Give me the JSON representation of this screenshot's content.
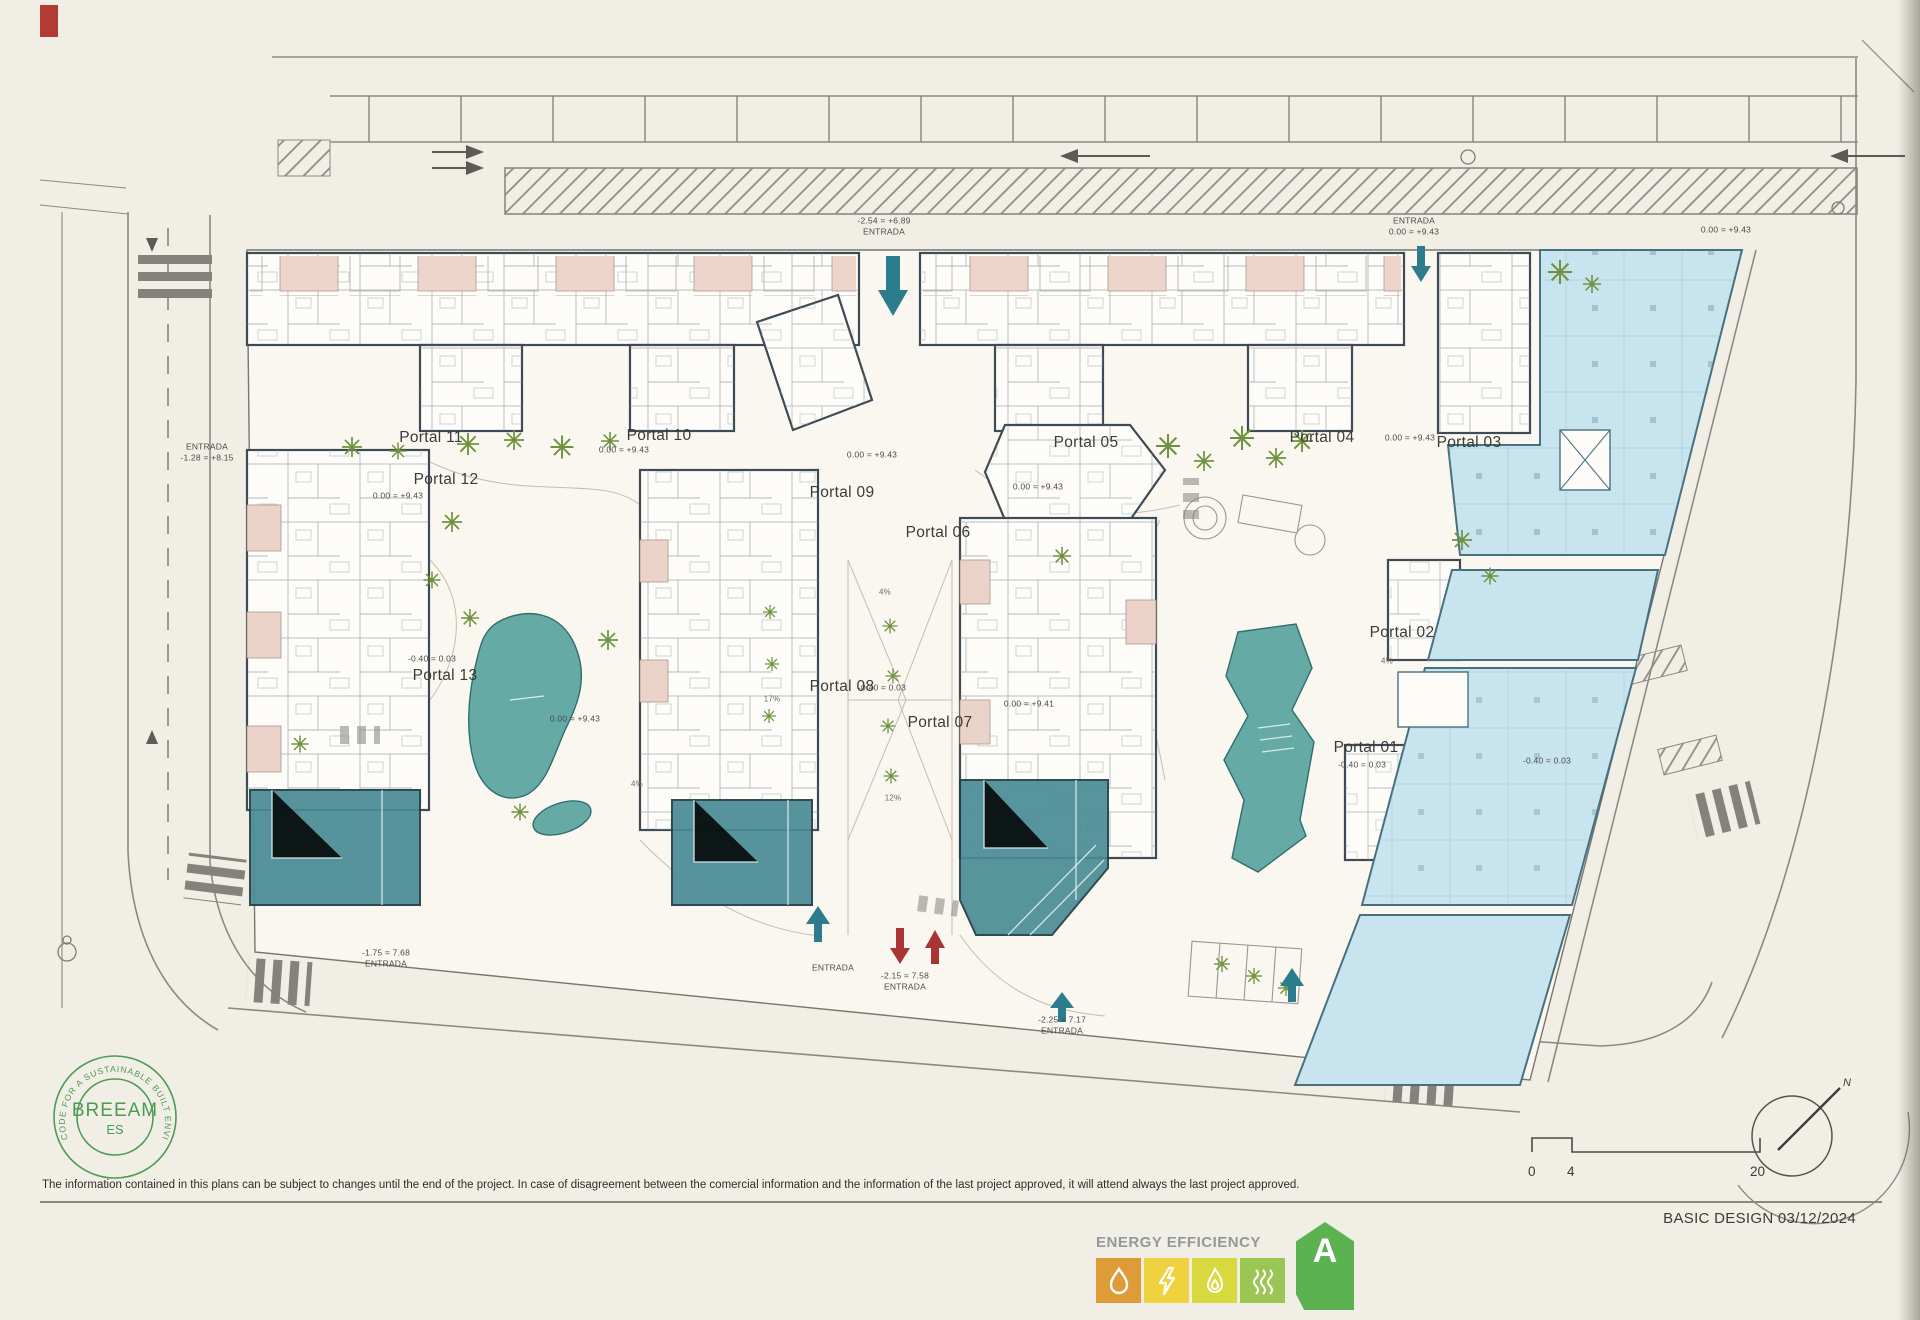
{
  "plan": {
    "portals": [
      {
        "id": "portal-11",
        "label": "Portal 11",
        "x": 431,
        "y": 438
      },
      {
        "id": "portal-10",
        "label": "Portal 10",
        "x": 659,
        "y": 436
      },
      {
        "id": "portal-12",
        "label": "Portal 12",
        "x": 446,
        "y": 480
      },
      {
        "id": "portal-13",
        "label": "Portal 13",
        "x": 445,
        "y": 676
      },
      {
        "id": "portal-09",
        "label": "Portal 09",
        "x": 842,
        "y": 493
      },
      {
        "id": "portal-08",
        "label": "Portal 08",
        "x": 842,
        "y": 687
      },
      {
        "id": "portal-07",
        "label": "Portal 07",
        "x": 940,
        "y": 723
      },
      {
        "id": "portal-06",
        "label": "Portal 06",
        "x": 938,
        "y": 533
      },
      {
        "id": "portal-05",
        "label": "Portal 05",
        "x": 1086,
        "y": 443
      },
      {
        "id": "portal-04",
        "label": "Portal 04",
        "x": 1322,
        "y": 438
      },
      {
        "id": "portal-03",
        "label": "Portal 03",
        "x": 1469,
        "y": 443
      },
      {
        "id": "portal-02",
        "label": "Portal 02",
        "x": 1402,
        "y": 633
      },
      {
        "id": "portal-01",
        "label": "Portal 01",
        "x": 1366,
        "y": 748
      }
    ],
    "annotations": [
      {
        "x": 884,
        "y": 227,
        "lines": [
          "-2.54 = +6.89",
          "ENTRADA"
        ]
      },
      {
        "x": 1414,
        "y": 227,
        "lines": [
          "ENTRADA",
          "0.00 = +9.43"
        ]
      },
      {
        "x": 1726,
        "y": 230,
        "lines": [
          "0.00 = +9.43"
        ]
      },
      {
        "x": 207,
        "y": 453,
        "lines": [
          "ENTRADA",
          "-1.28 = +8.15"
        ]
      },
      {
        "x": 624,
        "y": 450,
        "lines": [
          "0.00 = +9.43"
        ]
      },
      {
        "x": 398,
        "y": 496,
        "lines": [
          "0.00 = +9.43"
        ]
      },
      {
        "x": 872,
        "y": 455,
        "lines": [
          "0.00 = +9.43"
        ]
      },
      {
        "x": 1410,
        "y": 438,
        "lines": [
          "0.00 = +9.43"
        ]
      },
      {
        "x": 1038,
        "y": 487,
        "lines": [
          "0.00 = +9.43"
        ]
      },
      {
        "x": 432,
        "y": 659,
        "lines": [
          "-0.40 = 0.03"
        ]
      },
      {
        "x": 882,
        "y": 688,
        "lines": [
          "-0.40 = 0.03"
        ]
      },
      {
        "x": 575,
        "y": 719,
        "lines": [
          "0.00 = +9.43"
        ]
      },
      {
        "x": 1029,
        "y": 704,
        "lines": [
          "0.00 = +9.41"
        ]
      },
      {
        "x": 1362,
        "y": 765,
        "lines": [
          "-0.40 = 0.03"
        ]
      },
      {
        "x": 1547,
        "y": 761,
        "lines": [
          "-0.40 = 0.03"
        ]
      },
      {
        "x": 386,
        "y": 959,
        "lines": [
          "-1.75 = 7.68",
          "ENTRADA"
        ]
      },
      {
        "x": 833,
        "y": 968,
        "lines": [
          "ENTRADA"
        ]
      },
      {
        "x": 905,
        "y": 982,
        "lines": [
          "-2.15 = 7.58",
          "ENTRADA"
        ]
      },
      {
        "x": 1062,
        "y": 1026,
        "lines": [
          "-2.25 = 7.17",
          "ENTRADA"
        ]
      },
      {
        "x": 885,
        "y": 593,
        "cls": "slope",
        "lines": [
          "4%"
        ]
      },
      {
        "x": 637,
        "y": 785,
        "cls": "slope",
        "lines": [
          "4%"
        ]
      },
      {
        "x": 893,
        "y": 799,
        "cls": "slope",
        "lines": [
          "12%"
        ]
      },
      {
        "x": 772,
        "y": 700,
        "cls": "slope",
        "lines": [
          "17%"
        ]
      },
      {
        "x": 1387,
        "y": 662,
        "cls": "slope",
        "lines": [
          "4%"
        ]
      }
    ]
  },
  "breeam": {
    "ring_text": "CODE FOR A SUSTAINABLE BUILT ENVIRONMENT",
    "name": "BREEAM",
    "region": "ES",
    "color": "#4c9b52"
  },
  "footer": {
    "disclaimer": "The information contained in this plans can be subject to changes until the end of the project. In case of disagreement between the comercial information and the information of the last project approved, it will attend always the last project approved.",
    "stamp": "BASIC DESIGN 03/12/2024"
  },
  "energy": {
    "title": "ENERGY EFFICIENCY",
    "rating": "A",
    "icons": [
      "water-drop",
      "lightning",
      "flame",
      "heat-waves"
    ],
    "colors": {
      "water": "#df9b37",
      "electric": "#f0d23e",
      "gas": "#d8d83f",
      "heat": "#9cc653",
      "arrow": "#5cb151"
    }
  },
  "scale_bar": {
    "ticks": [
      "0",
      "4",
      "20"
    ]
  },
  "compass": {
    "label": "N"
  },
  "palette": {
    "pool": "#66aaa6",
    "retail": "#4a8b95",
    "commercial": "#c8e4ef",
    "terrace": "#ecd3ca",
    "wall": "#3e4a54",
    "road": "#8a8a83",
    "arrow_teal": "#2b7d8e",
    "arrow_red": "#a83434"
  }
}
